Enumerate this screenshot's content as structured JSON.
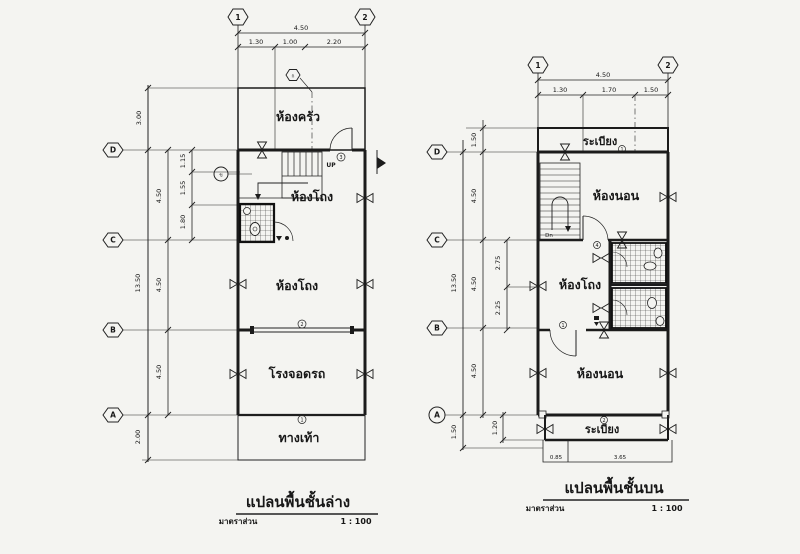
{
  "left_plan": {
    "title": "แปลนพื้นชั้นล่าง",
    "scale_label": "มาตราส่วน",
    "scale_value": "1 : 100",
    "grid_cols": [
      "1",
      "2"
    ],
    "grid_rows": [
      "D",
      "C",
      "B",
      "A"
    ],
    "dims": {
      "top_total": "4.50",
      "top_segs": [
        "1.30",
        "1.00",
        "2.20"
      ],
      "v3": "3.00",
      "overall": "13.50",
      "rows": [
        "4.50",
        "4.50",
        "4.50"
      ],
      "subs": [
        "1.15",
        "1.55",
        "1.80"
      ],
      "v2": "2.00"
    },
    "rooms": {
      "kitchen": "ห้องครัว",
      "hall_upper": "ห้องโถง",
      "hall_lower": "ห้องโถง",
      "garage": "โรงจอดรถ",
      "walkway": "ทางเท้า"
    },
    "stair_label": "UP",
    "tags": {
      "kitchen": "ก",
      "stair": "ข",
      "wall_d": "3",
      "wall_b": "2",
      "wall_a": "1"
    }
  },
  "right_plan": {
    "title": "แปลนพื้นชั้นบน",
    "scale_label": "มาตราส่วน",
    "scale_value": "1 : 100",
    "grid_cols": [
      "1",
      "2"
    ],
    "grid_rows": [
      "D",
      "C",
      "B",
      "A"
    ],
    "dims": {
      "top_total": "4.50",
      "top_segs": [
        "1.30",
        "1.70",
        "1.50"
      ],
      "balcony_top": "1.50",
      "overall": "13.50",
      "rows": [
        "4.50",
        "4.50",
        "4.50"
      ],
      "bottom_outer": "1.50",
      "bottom_inner": "1.20",
      "hall_subs": [
        "2.75",
        "2.25"
      ],
      "bottom_widths": [
        "0.85",
        "3.65"
      ]
    },
    "rooms": {
      "balcony_top": "ระเบียง",
      "bedroom_upper": "ห้องนอน",
      "hall": "ห้องโถง",
      "bedroom_lower": "ห้องนอน",
      "balcony_bottom": "ระเบียง"
    },
    "stair_label": "Dn",
    "tags": {
      "balcony": "1",
      "c_wall": "4",
      "b_wall": "1",
      "a_wall": "2"
    }
  }
}
